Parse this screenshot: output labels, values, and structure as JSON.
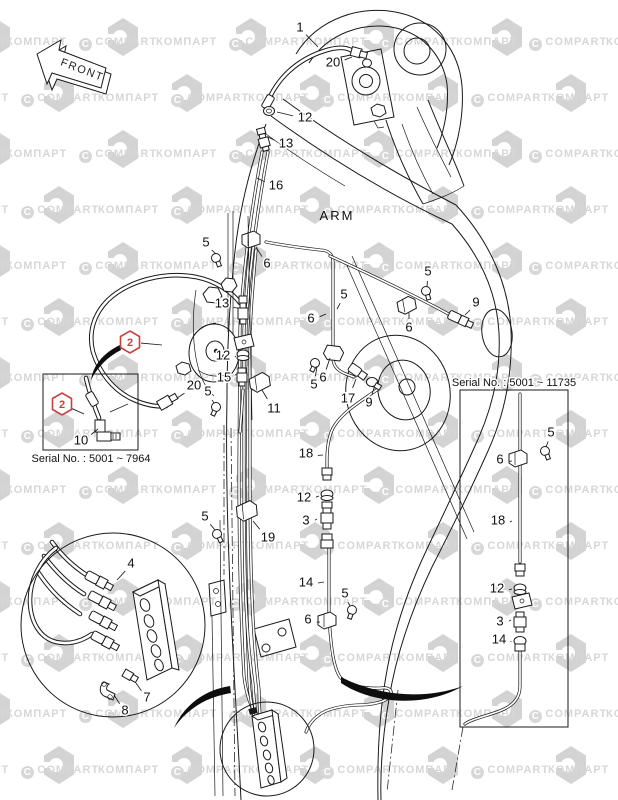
{
  "front_arrow": {
    "label": "FRONT"
  },
  "arm_label": "ARM",
  "serials": [
    {
      "text": "Serial No. : 5001 ~ 7964",
      "x": 91,
      "y": 462
    },
    {
      "text": "Serial No. : 5001 ~ 11735",
      "x": 514,
      "y": 386
    }
  ],
  "markers": [
    {
      "num": "2",
      "x": 130,
      "y": 342,
      "tx": 162,
      "ty": 345
    },
    {
      "num": "2",
      "x": 62,
      "y": 404,
      "tx": 84,
      "ty": 414
    }
  ],
  "part_labels": [
    {
      "t": "1",
      "x": 300,
      "y": 27,
      "tx": 318,
      "ty": 47
    },
    {
      "t": "20",
      "x": 333,
      "y": 62,
      "tx": 352,
      "ty": 57
    },
    {
      "t": "12",
      "x": 305,
      "y": 117,
      "tx": 277,
      "ty": 112
    },
    {
      "t": "13",
      "x": 286,
      "y": 143,
      "tx": 268,
      "ty": 137
    },
    {
      "t": "16",
      "x": 276,
      "y": 185,
      "tx": 257,
      "ty": 178
    },
    {
      "t": "5",
      "x": 206,
      "y": 242,
      "tx": 216,
      "ty": 254
    },
    {
      "t": "6",
      "x": 267,
      "y": 263,
      "tx": 256,
      "ty": 247
    },
    {
      "t": "5",
      "x": 428,
      "y": 271,
      "tx": 427,
      "ty": 287
    },
    {
      "t": "9",
      "x": 476,
      "y": 302,
      "tx": 465,
      "ty": 315
    },
    {
      "t": "6",
      "x": 409,
      "y": 327,
      "tx": 409,
      "ty": 313
    },
    {
      "t": "5",
      "x": 344,
      "y": 294,
      "tx": 337,
      "ty": 309
    },
    {
      "t": "6",
      "x": 311,
      "y": 318,
      "tx": 326,
      "ty": 314
    },
    {
      "t": "13",
      "x": 222,
      "y": 303,
      "tx": 238,
      "ty": 308
    },
    {
      "t": "12",
      "x": 223,
      "y": 355,
      "tx": 236,
      "ty": 356
    },
    {
      "t": "15",
      "x": 224,
      "y": 377,
      "tx": 236,
      "ty": 374
    },
    {
      "t": "20",
      "x": 194,
      "y": 385,
      "tx": 177,
      "ty": 398
    },
    {
      "t": "5",
      "x": 208,
      "y": 391,
      "tx": 214,
      "ty": 403
    },
    {
      "t": "11",
      "x": 274,
      "y": 408,
      "tx": 262,
      "ty": 390
    },
    {
      "t": "6",
      "x": 323,
      "y": 377,
      "tx": 330,
      "ty": 358
    },
    {
      "t": "5",
      "x": 314,
      "y": 384,
      "tx": 317,
      "ty": 366
    },
    {
      "t": "17",
      "x": 348,
      "y": 398,
      "tx": 356,
      "ty": 379
    },
    {
      "t": "9",
      "x": 369,
      "y": 402,
      "tx": 374,
      "ty": 388
    },
    {
      "t": "18",
      "x": 306,
      "y": 453,
      "tx": 323,
      "ty": 455
    },
    {
      "t": "12",
      "x": 304,
      "y": 497,
      "tx": 319,
      "ty": 496
    },
    {
      "t": "3",
      "x": 306,
      "y": 520,
      "tx": 317,
      "ty": 519
    },
    {
      "t": "14",
      "x": 306,
      "y": 582,
      "tx": 324,
      "ty": 582
    },
    {
      "t": "5",
      "x": 345,
      "y": 593,
      "tx": 350,
      "ty": 606
    },
    {
      "t": "6",
      "x": 308,
      "y": 619,
      "tx": 320,
      "ty": 622
    },
    {
      "t": "19",
      "x": 268,
      "y": 537,
      "tx": 253,
      "ty": 521
    },
    {
      "t": "5",
      "x": 205,
      "y": 516,
      "tx": 215,
      "ty": 530
    },
    {
      "t": "4",
      "x": 131,
      "y": 563,
      "tx": 117,
      "ty": 580
    },
    {
      "t": "7",
      "x": 147,
      "y": 697,
      "tx": 136,
      "ty": 683
    },
    {
      "t": "8",
      "x": 125,
      "y": 710,
      "tx": 114,
      "ty": 695
    },
    {
      "t": "10",
      "x": 81,
      "y": 440,
      "tx": 98,
      "ty": 429
    },
    {
      "t": "5",
      "x": 551,
      "y": 432,
      "tx": 546,
      "ty": 447
    },
    {
      "t": "6",
      "x": 500,
      "y": 459,
      "tx": 512,
      "ty": 461
    },
    {
      "t": "18",
      "x": 498,
      "y": 520,
      "tx": 512,
      "ty": 521
    },
    {
      "t": "12",
      "x": 497,
      "y": 588,
      "tx": 512,
      "ty": 589
    },
    {
      "t": "3",
      "x": 500,
      "y": 621,
      "tx": 511,
      "ty": 620
    },
    {
      "t": "14",
      "x": 499,
      "y": 639,
      "tx": 511,
      "ty": 641
    }
  ],
  "watermark": {
    "words": [
      "КОМПАРТ",
      "COMPART"
    ],
    "c": "C",
    "text_color": "#d7d7d7",
    "badge_color": "#d3d3d3"
  },
  "colors": {
    "line": "#1a1a1a",
    "accent_red": "#c8403d",
    "paper": "#ffffff"
  }
}
